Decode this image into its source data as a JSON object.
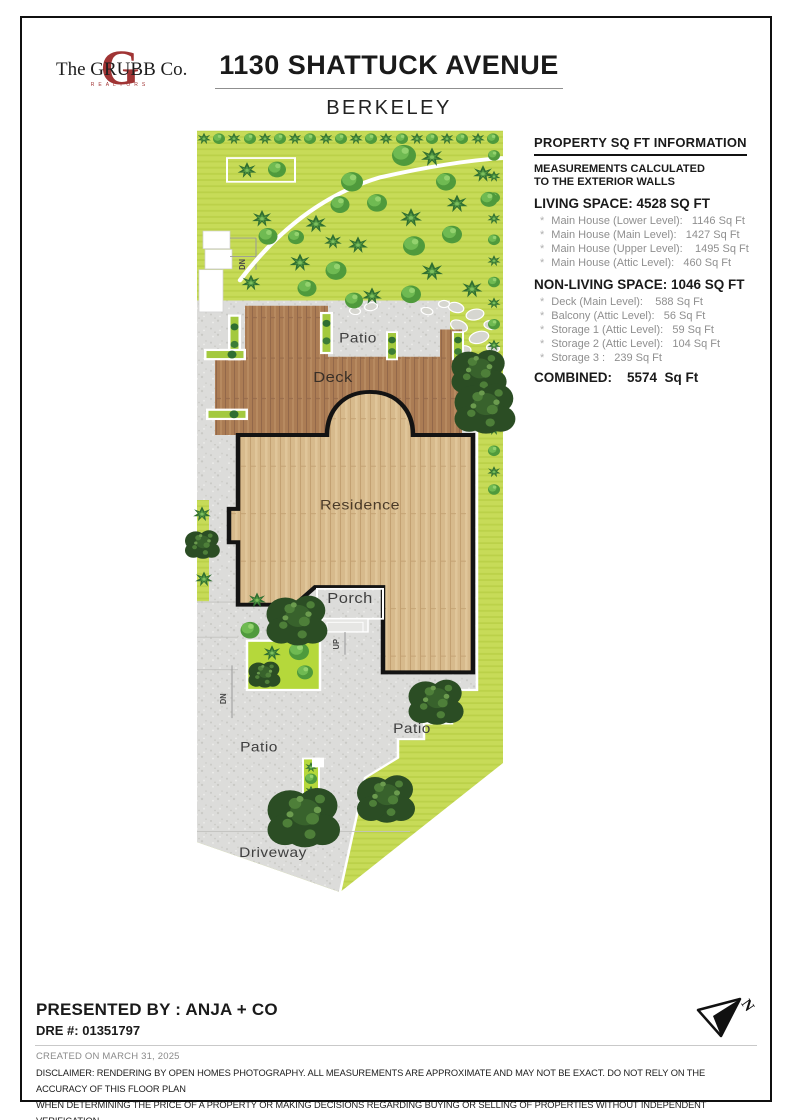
{
  "header": {
    "title": "1130 SHATTUCK AVENUE",
    "subtitle": "BERKELEY"
  },
  "logo": {
    "big_letter": "G",
    "name": "The GRUBB Co.",
    "sub": "REALTORS",
    "accent_color": "#a03434"
  },
  "info_panel": {
    "bullet": "*",
    "title": "PROPERTY SQ FT INFORMATION",
    "note_line1": "MEASUREMENTS CALCULATED",
    "note_line2": "TO THE EXTERIOR WALLS",
    "living_header": "LIVING SPACE: 4528 SQ FT",
    "living_items": [
      "Main House (Lower Level):   1146 Sq Ft",
      "Main House (Main Level):   1427 Sq Ft",
      "Main House (Upper Level):    1495 Sq Ft",
      "Main House (Attic Level):   460 Sq Ft"
    ],
    "nonliving_header": "NON-LIVING SPACE: 1046 SQ FT",
    "nonliving_items": [
      "Deck (Main Level):    588 Sq Ft",
      "Balcony (Attic Level):   56 Sq Ft",
      "Storage 1 (Attic Level):   59 Sq Ft",
      "Storage 2 (Attic Level):   104 Sq Ft",
      "Storage 3 :   239 Sq Ft"
    ],
    "combined_label": "COMBINED:",
    "combined_value": "5574  Sq Ft"
  },
  "site_plan": {
    "labels": {
      "patio_top": "Patio",
      "deck": "Deck",
      "residence": "Residence",
      "porch": "Porch",
      "up": "UP",
      "dn_upper": "DN",
      "dn_lower": "DN",
      "patio_left": "Patio",
      "patio_right": "Patio",
      "driveway": "Driveway"
    },
    "north_label": "N",
    "palette": {
      "lawn": "#c7db58",
      "lawn_stripe": "#bbd149",
      "garden_bed": "#b5d83b",
      "concrete": "#dcdcda",
      "deck_wood": "#ab7c54",
      "residence_wood": "#d7ba8c",
      "outline": "#131313",
      "tree_light": "#6fba52",
      "tree_dark": "#2b4d24",
      "path": "#ffffff"
    }
  },
  "footer": {
    "presented_by": "PRESENTED BY : ANJA + CO",
    "dre": "DRE #: 01351797",
    "created": "CREATED ON MARCH 31, 2025",
    "disclaimer_line1": "DISCLAIMER: RENDERING BY OPEN HOMES PHOTOGRAPHY. ALL MEASUREMENTS ARE APPROXIMATE AND MAY NOT BE EXACT. DO NOT RELY ON THE ACCURACY OF THIS FLOOR PLAN",
    "disclaimer_line2": "WHEN DETERMINING THE PRICE OF A PROPERTY OR MAKING DECISIONS REGARDING BUYING OR SELLING OF PROPERTIES WITHOUT INDEPENDENT VERIFICATION."
  }
}
